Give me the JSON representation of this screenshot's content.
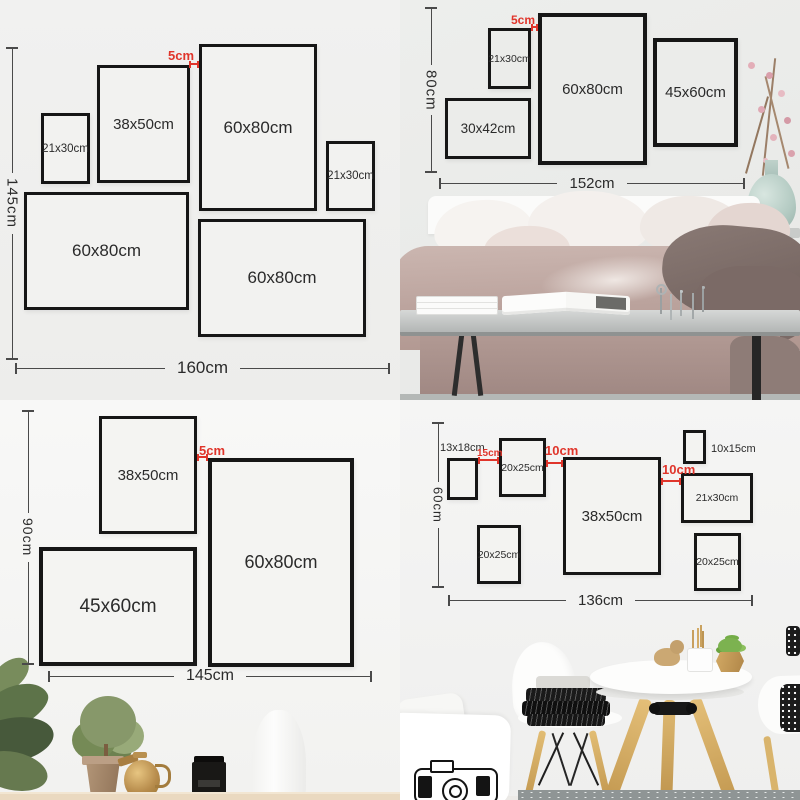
{
  "colors": {
    "accent_red": "#e0352b",
    "frame_border": "#161616",
    "dimension_line": "#4a4a4a",
    "text": "#2b2b2b"
  },
  "quadrants": [
    {
      "name": "gallery-wall-layout-160x145",
      "vertical_dim": "145cm",
      "horizontal_dim": "160cm",
      "gap_label": "5cm",
      "frames": [
        {
          "label": "21x30cm"
        },
        {
          "label": "38x50cm"
        },
        {
          "label": "60x80cm"
        },
        {
          "label": "21x30cm"
        },
        {
          "label": "60x80cm"
        },
        {
          "label": "60x80cm"
        }
      ]
    },
    {
      "name": "bedroom-wall-layout-152x80",
      "vertical_dim": "80cm",
      "horizontal_dim": "152cm",
      "gap_label": "5cm",
      "frames": [
        {
          "label": "21x30cm"
        },
        {
          "label": "60x80cm"
        },
        {
          "label": "45x60cm"
        },
        {
          "label": "30x42cm"
        }
      ]
    },
    {
      "name": "gallery-wall-layout-145x90",
      "vertical_dim": "90cm",
      "horizontal_dim": "145cm",
      "gap_label": "5cm",
      "frames": [
        {
          "label": "38x50cm"
        },
        {
          "label": "60x80cm"
        },
        {
          "label": "45x60cm"
        }
      ]
    },
    {
      "name": "dining-wall-layout-136x60",
      "vertical_dim": "60cm",
      "horizontal_dim": "136cm",
      "gap_labels": [
        "15cm",
        "10cm",
        "10cm"
      ],
      "frames": [
        {
          "label": "13x18cm"
        },
        {
          "label": "20x25cm"
        },
        {
          "label": "38x50cm"
        },
        {
          "label": "10x15cm"
        },
        {
          "label": "21x30cm"
        },
        {
          "label": "20x25cm"
        },
        {
          "label": "20x25cm"
        }
      ]
    }
  ]
}
